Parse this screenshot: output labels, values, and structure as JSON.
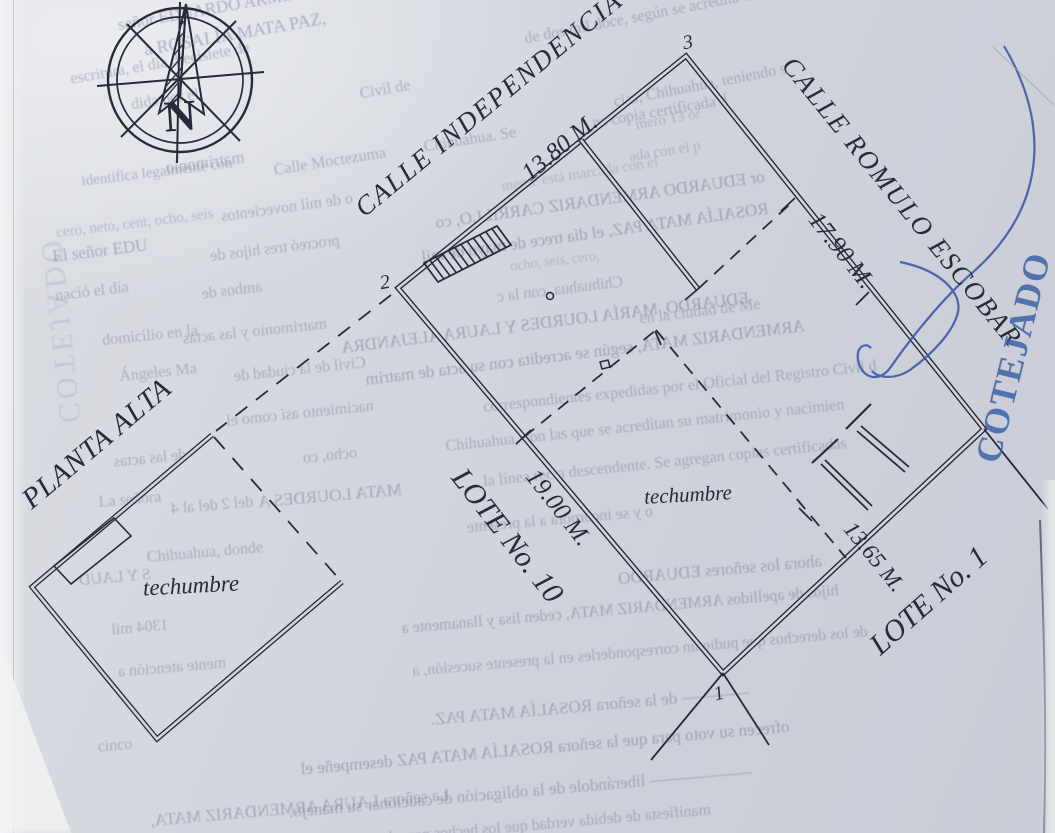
{
  "compass": {
    "north_letter": "N"
  },
  "plan": {
    "streets": {
      "independencia": "CALLE INDEPENDENCIA",
      "romulo_escobar": "CALLE ROMULO ESCOBAR"
    },
    "dimensions": {
      "front": "13.80 M.",
      "right": "17.90 M.",
      "left": "19.00 M.",
      "back": "13.65 M."
    },
    "lots": {
      "lot10": "LOTE No. 10",
      "lot1": "LOTE No. 1"
    },
    "labels": {
      "planta_alta": "PLANTA ALTA",
      "techumbre_lot": "techumbre",
      "techumbre_building": "techumbre"
    },
    "vertices": {
      "v1": "1",
      "v2": "2",
      "v3": "3"
    }
  },
  "stamp": {
    "text": "COTEJADO",
    "color": "#3c62a6"
  },
  "ink": {
    "plan_color": "#262b3a",
    "pen_color": "#4058a8"
  },
  "bleed_lines": [
    {
      "t": "señor EDUARDO ARME",
      "x": 205,
      "y": 10,
      "s": 17,
      "r": -10,
      "m": false,
      "o": 0.42
    },
    {
      "t": "de dos mil doce, según se acredita con",
      "x": 645,
      "y": 16,
      "s": 16,
      "r": -11,
      "m": false
    },
    {
      "t": "a ROSALÍA MATA PAZ,",
      "x": 235,
      "y": 34,
      "s": 18,
      "r": -10,
      "m": false,
      "o": 0.42
    },
    {
      "t": "escritura, el día diecisiete de",
      "x": 160,
      "y": 64,
      "s": 16,
      "r": -10,
      "m": false
    },
    {
      "t": "cias, Chihuahua, teniendo s",
      "x": 700,
      "y": 86,
      "s": 16,
      "r": -11,
      "m": false
    },
    {
      "t": "dida por el",
      "x": 165,
      "y": 100,
      "s": 16,
      "r": -9,
      "m": false
    },
    {
      "t": "Civil de",
      "x": 385,
      "y": 90,
      "s": 16,
      "r": -10,
      "m": false
    },
    {
      "t": "na copia certificada d",
      "x": 660,
      "y": 112,
      "s": 16,
      "r": -10,
      "m": false
    },
    {
      "t": "Chihuahua. Se",
      "x": 470,
      "y": 140,
      "s": 16,
      "r": -9,
      "m": false
    },
    {
      "t": "mero 13 or",
      "x": 668,
      "y": 120,
      "s": 15,
      "r": -10,
      "m": false,
      "o": 0.3
    },
    {
      "t": "ada con el p",
      "x": 665,
      "y": 152,
      "s": 15,
      "r": -9,
      "m": false,
      "o": 0.3
    },
    {
      "t": "Calle Moctezuma",
      "x": 330,
      "y": 162,
      "s": 16,
      "r": -9,
      "m": false
    },
    {
      "t": "matrimonio",
      "x": 205,
      "y": 163,
      "s": 17,
      "r": -8,
      "m": true
    },
    {
      "t": "identifica legalmente con",
      "x": 157,
      "y": 173,
      "s": 15,
      "r": -7,
      "m": false
    },
    {
      "t": "o de mil novecientos",
      "x": 287,
      "y": 208,
      "s": 16,
      "r": -8,
      "m": true
    },
    {
      "t": "cero, neto, cent, ocho, seis",
      "x": 135,
      "y": 224,
      "s": 15,
      "r": -7,
      "m": false,
      "o": 0.3
    },
    {
      "t": "mente está marcada con el",
      "x": 580,
      "y": 175,
      "s": 15,
      "r": -9,
      "m": false,
      "o": 0.28
    },
    {
      "t": "El señor EDU",
      "x": 100,
      "y": 251,
      "s": 17,
      "r": -7,
      "m": false,
      "o": 0.42
    },
    {
      "t": "procreó tres hijos de",
      "x": 275,
      "y": 249,
      "s": 16,
      "r": -7,
      "m": true
    },
    {
      "t": "or EDUARDO ARMENDARIZ CARRILLO, co",
      "x": 600,
      "y": 200,
      "s": 17,
      "r": -8,
      "m": true,
      "o": 0.45
    },
    {
      "t": "ROSALÍA MATA PAZ, el día trece de mayo de mil",
      "x": 595,
      "y": 233,
      "s": 17,
      "r": -8,
      "m": true,
      "o": 0.45
    },
    {
      "t": "ocho, seis, cero,",
      "x": 555,
      "y": 262,
      "s": 14,
      "r": -7,
      "m": false,
      "o": 0.28
    },
    {
      "t": "nació el día",
      "x": 92,
      "y": 292,
      "s": 16,
      "r": -7,
      "m": false
    },
    {
      "t": "ambos de",
      "x": 232,
      "y": 291,
      "s": 16,
      "r": -7,
      "m": true
    },
    {
      "t": "Chihuahua, con la c",
      "x": 560,
      "y": 290,
      "s": 16,
      "r": -7,
      "m": true
    },
    {
      "t": "en la ciudad de Me",
      "x": 700,
      "y": 312,
      "s": 16,
      "r": -7,
      "m": false
    },
    {
      "t": "EDUARDO, MARÍA LOURDES Y LAURA ALEJANDRA",
      "x": 545,
      "y": 323,
      "s": 17,
      "r": -7,
      "m": true,
      "o": 0.45
    },
    {
      "t": "domicilio en la",
      "x": 150,
      "y": 336,
      "s": 16,
      "r": -6,
      "m": false
    },
    {
      "t": "matrimonio y las actas",
      "x": 255,
      "y": 332,
      "s": 16,
      "r": -6,
      "m": true
    },
    {
      "t": "ARMENDARIZ MATA, según se acredita con su acta de matrim",
      "x": 585,
      "y": 353,
      "s": 17,
      "r": -7,
      "m": true,
      "o": 0.45
    },
    {
      "t": "Ángeles Ma",
      "x": 158,
      "y": 373,
      "s": 16,
      "r": -6,
      "m": false
    },
    {
      "t": "Civil de la ciudad de",
      "x": 300,
      "y": 370,
      "s": 16,
      "r": -6,
      "m": true
    },
    {
      "t": "correspondientes expedidas por el Oficial del Registro Civil d",
      "x": 680,
      "y": 387,
      "s": 16,
      "r": -6,
      "m": false
    },
    {
      "t": "nacimiento así como el",
      "x": 300,
      "y": 414,
      "s": 16,
      "r": -6,
      "m": true
    },
    {
      "t": "Chihuahua, con las que se acreditan su matrimonio y nacimien",
      "x": 645,
      "y": 426,
      "s": 16,
      "r": -6,
      "m": false
    },
    {
      "t": "ocho, co",
      "x": 330,
      "y": 456,
      "s": 16,
      "r": -6,
      "m": true
    },
    {
      "t": "de las actas",
      "x": 150,
      "y": 459,
      "s": 16,
      "r": -6,
      "m": true
    },
    {
      "t": "la línea recta descendente. Se agregan copias certificadas",
      "x": 665,
      "y": 463,
      "s": 16,
      "r": -6,
      "m": false
    },
    {
      "t": "La señora",
      "x": 130,
      "y": 500,
      "s": 16,
      "r": -5,
      "m": false
    },
    {
      "t": "MATA LOURDES A",
      "x": 330,
      "y": 496,
      "s": 17,
      "r": -5,
      "m": true,
      "o": 0.42
    },
    {
      "t": "del 2 del al 4",
      "x": 212,
      "y": 506,
      "s": 16,
      "r": -5,
      "m": true
    },
    {
      "t": "o y se incorpora a la presente",
      "x": 560,
      "y": 520,
      "s": 16,
      "r": -5,
      "m": true
    },
    {
      "t": "Chihuahua, donde",
      "x": 205,
      "y": 553,
      "s": 16,
      "r": -5,
      "m": false
    },
    {
      "t": "ahora los señores EDUARDO",
      "x": 720,
      "y": 570,
      "s": 17,
      "r": -5,
      "m": true,
      "o": 0.42
    },
    {
      "t": "S Y LAUD",
      "x": 115,
      "y": 578,
      "s": 16,
      "r": -5,
      "m": true
    },
    {
      "t": "hijos de apellidos ARMENDARIZ MATA, ceden lisa y llanamente a",
      "x": 620,
      "y": 610,
      "s": 16,
      "r": -5,
      "m": true,
      "o": 0.42
    },
    {
      "t": "1304 mil",
      "x": 140,
      "y": 628,
      "s": 16,
      "r": -5,
      "m": true
    },
    {
      "t": "de los derechos que pudieran corresponderles en la presente sucesión, a",
      "x": 640,
      "y": 652,
      "s": 16,
      "r": -5,
      "m": true
    },
    {
      "t": "mente atención a",
      "x": 172,
      "y": 668,
      "s": 16,
      "r": -5,
      "m": true
    },
    {
      "t": "———— de la señora ROSALÍA MATA PAZ.",
      "x": 590,
      "y": 706,
      "s": 17,
      "r": -5,
      "m": true,
      "o": 0.42
    },
    {
      "t": "cinco",
      "x": 115,
      "y": 746,
      "s": 16,
      "r": -5,
      "m": false
    },
    {
      "t": "ofrecen su voto para que la señora ROSALÍA MATA PAZ desempeñe el",
      "x": 545,
      "y": 748,
      "s": 17,
      "r": -5,
      "m": true,
      "o": 0.45
    },
    {
      "t": "—————— liberándole de la obligación de caucionar su manejo.",
      "x": 520,
      "y": 792,
      "s": 17,
      "r": -5,
      "m": true,
      "o": 0.42
    },
    {
      "t": "La señora LAURA ARMENDARIZ MATA,",
      "x": 300,
      "y": 808,
      "s": 17,
      "r": -5,
      "m": true,
      "o": 0.4
    },
    {
      "t": "manifiesta de debida verdad que los hechos narrados ante el",
      "x": 520,
      "y": 827,
      "s": 16,
      "r": -5,
      "m": true
    },
    {
      "t": "COTEJADO",
      "x": 60,
      "y": 330,
      "s": 30,
      "r": 84,
      "m": true,
      "o": 0.16,
      "ls": 4
    }
  ]
}
